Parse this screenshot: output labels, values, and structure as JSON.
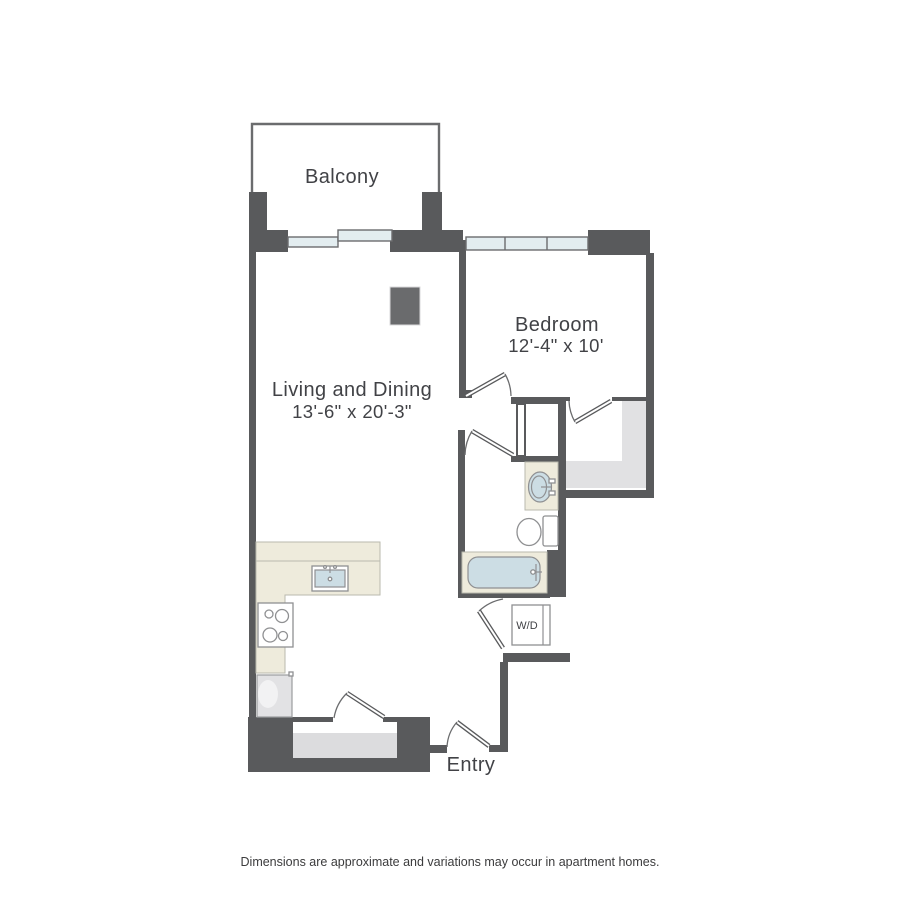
{
  "labels": {
    "balcony": "Balcony",
    "living_name": "Living and Dining",
    "living_dims": "13'-6\" x 20'-3\"",
    "bedroom_name": "Bedroom",
    "bedroom_dims": "12'-4\" x 10'",
    "washer_dryer": "W/D",
    "entry": "Entry",
    "disclaimer": "Dimensions are approximate and variations may occur in apartment homes."
  },
  "colors": {
    "wall": "#595a5c",
    "wall_outline": "#6b6c6e",
    "window_fill": "#e3edf0",
    "counter_beige": "#eeebdc",
    "fixture_blue": "#ccdde4",
    "fixture_stroke": "#8f9092",
    "closet_gray": "#e1e1e3",
    "label_text": "#414246"
  }
}
